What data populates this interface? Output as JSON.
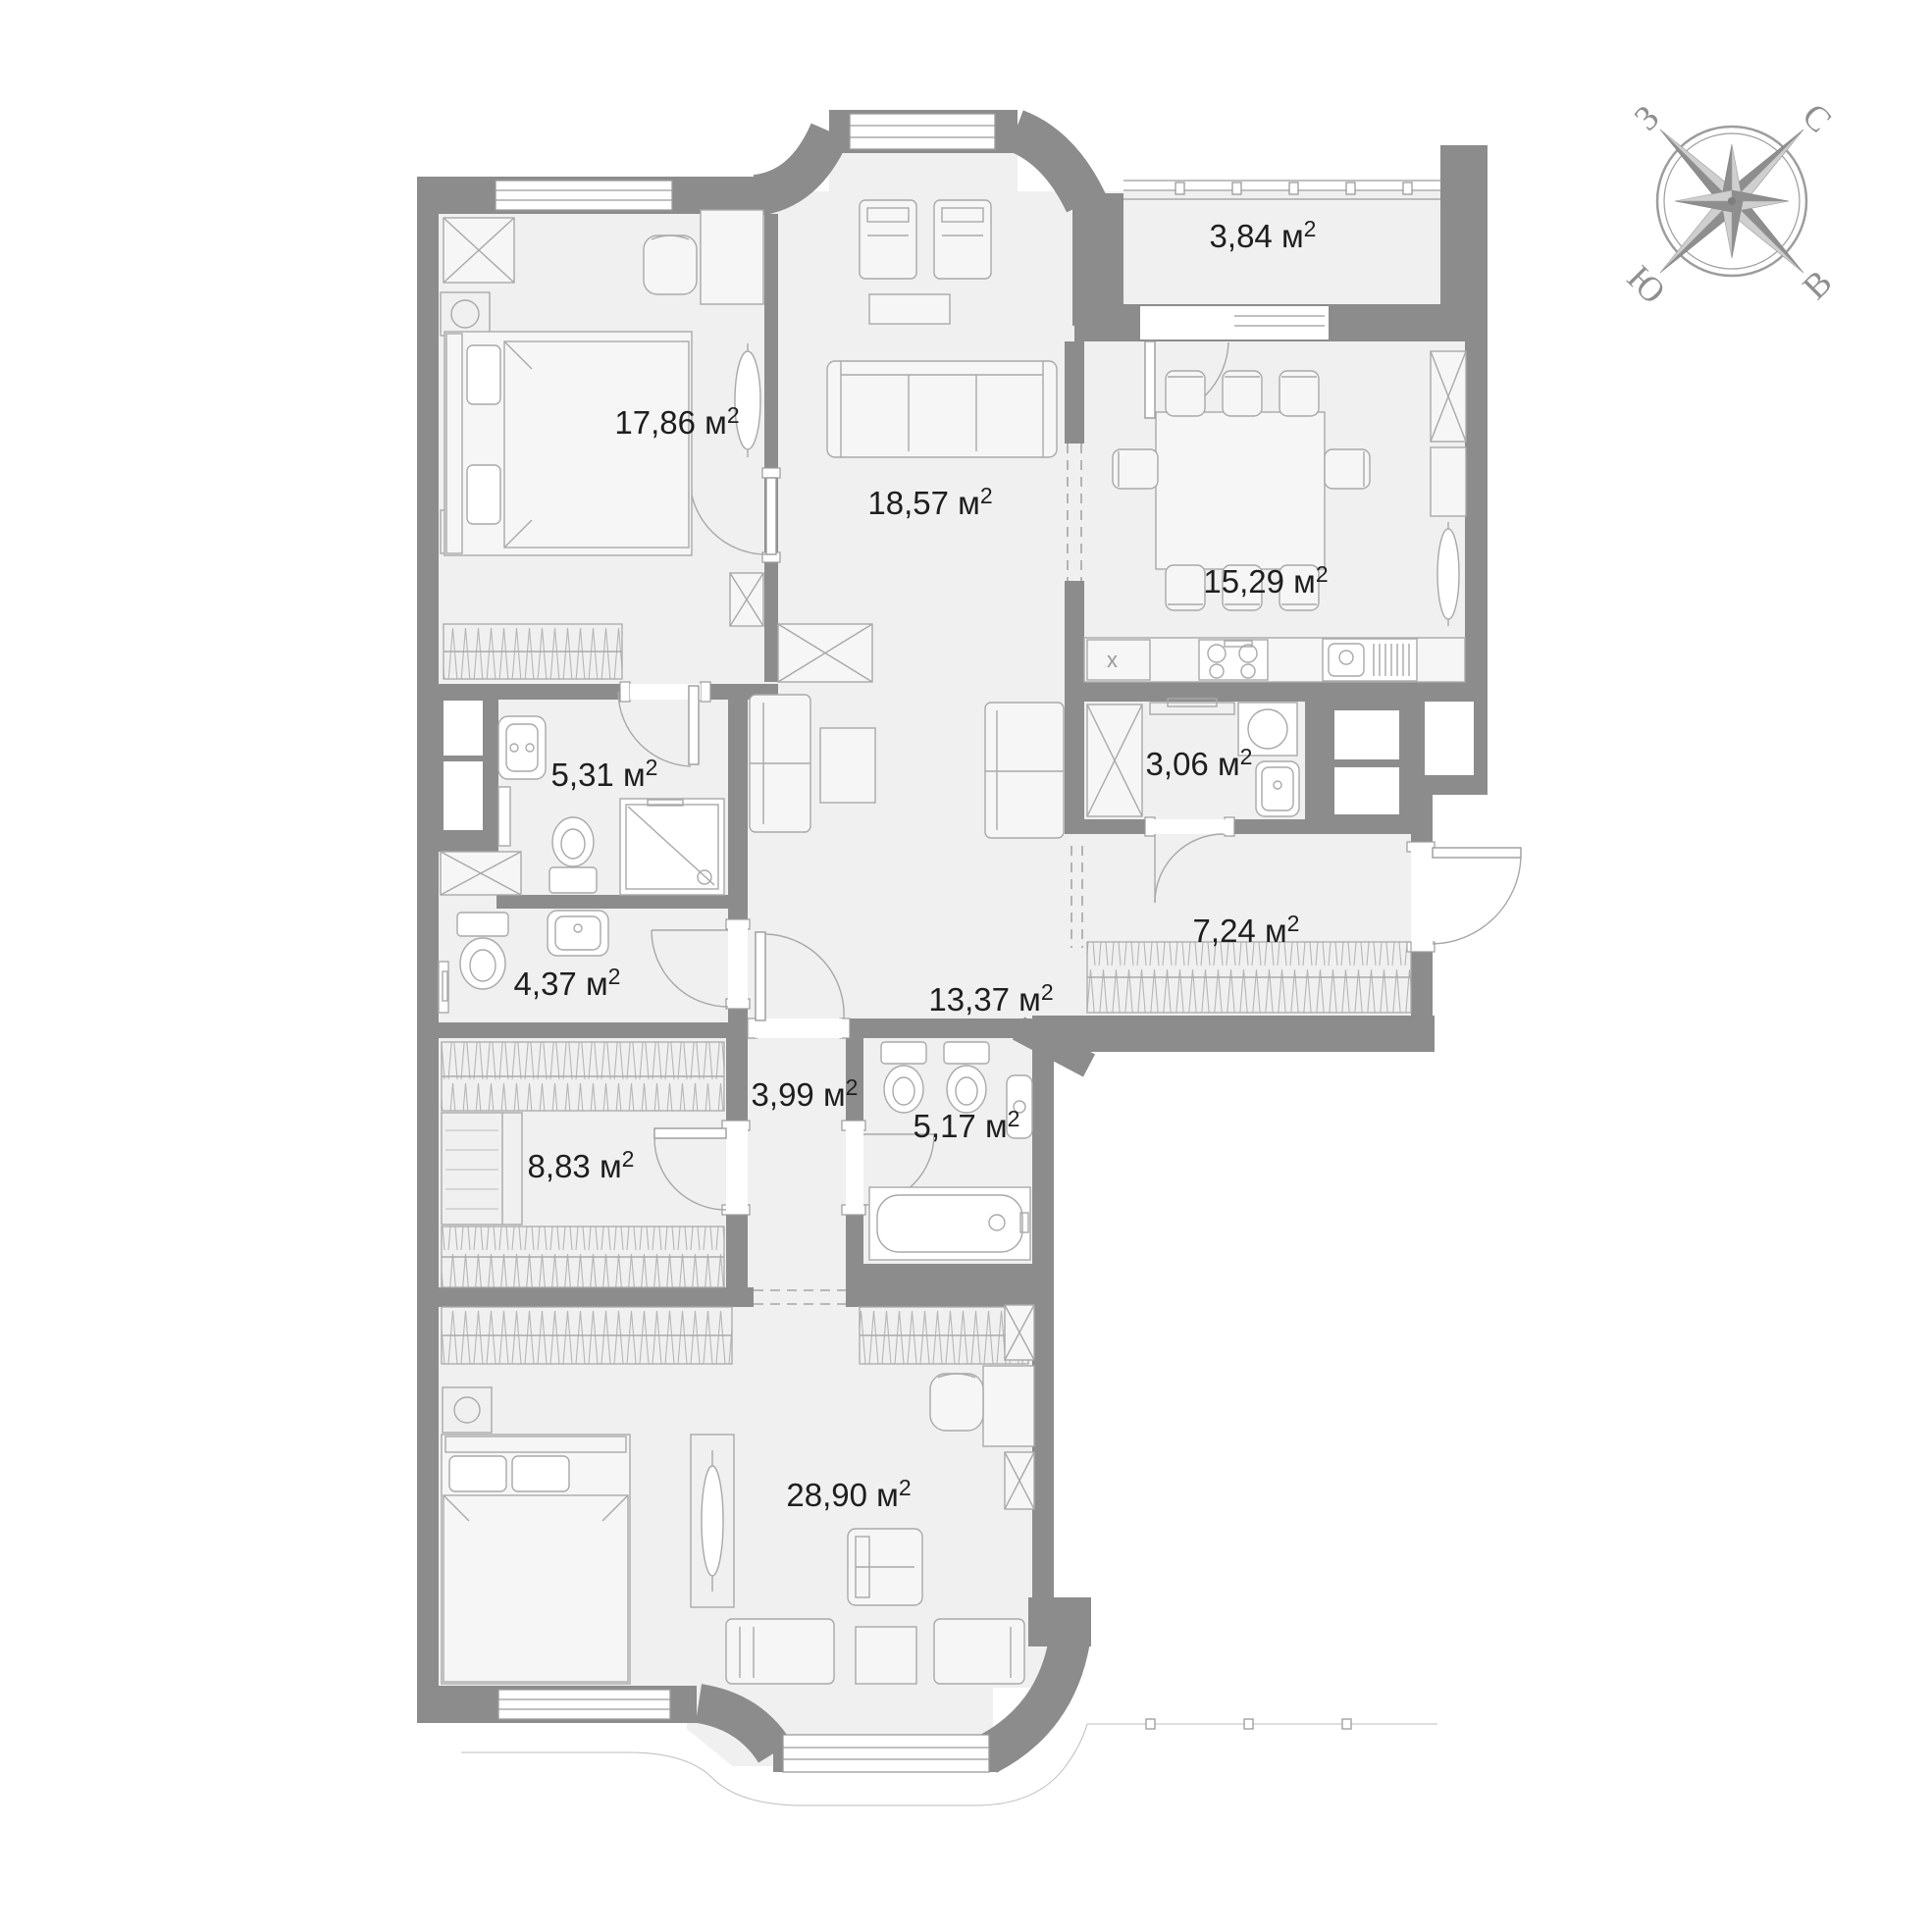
{
  "page": {
    "background": "#ffffff",
    "type": "apartment-floor-plan"
  },
  "colors": {
    "wall": "#8c8c8c",
    "floor": "#f0f0f0",
    "furniture_line": "#a9a9a9",
    "label_text": "#1e1e1e",
    "compass": "#8f8f8f"
  },
  "plan": {
    "area_unit": "м²",
    "rooms": [
      {
        "id": "bedroom-main",
        "label": "17,86 м",
        "sup": "2",
        "area_m2": "17,86"
      },
      {
        "id": "living-room",
        "label": "18,57 м",
        "sup": "2",
        "area_m2": "18,57"
      },
      {
        "id": "kitchen",
        "label": "15,29 м",
        "sup": "2",
        "area_m2": "15,29"
      },
      {
        "id": "balcony",
        "label": "3,84 м",
        "sup": "2",
        "area_m2": "3,84"
      },
      {
        "id": "bathroom-1",
        "label": "5,31 м",
        "sup": "2",
        "area_m2": "5,31"
      },
      {
        "id": "laundry",
        "label": "3,06 м",
        "sup": "2",
        "area_m2": "3,06"
      },
      {
        "id": "entry-hall",
        "label": "7,24 м",
        "sup": "2",
        "area_m2": "7,24"
      },
      {
        "id": "bathroom-2",
        "label": "4,37 м",
        "sup": "2",
        "area_m2": "4,37"
      },
      {
        "id": "hallway",
        "label": "13,37 м",
        "sup": "2",
        "area_m2": "13,37"
      },
      {
        "id": "corridor",
        "label": "3,99 м",
        "sup": "2",
        "area_m2": "3,99"
      },
      {
        "id": "bathroom-3",
        "label": "5,17 м",
        "sup": "2",
        "area_m2": "5,17"
      },
      {
        "id": "wardrobe-room",
        "label": "8,83 м",
        "sup": "2",
        "area_m2": "8,83"
      },
      {
        "id": "bedroom-2",
        "label": "28,90 м",
        "sup": "2",
        "area_m2": "28,90"
      }
    ]
  },
  "compass": {
    "north": "С",
    "east": "В",
    "south": "Ю",
    "west": "З"
  }
}
